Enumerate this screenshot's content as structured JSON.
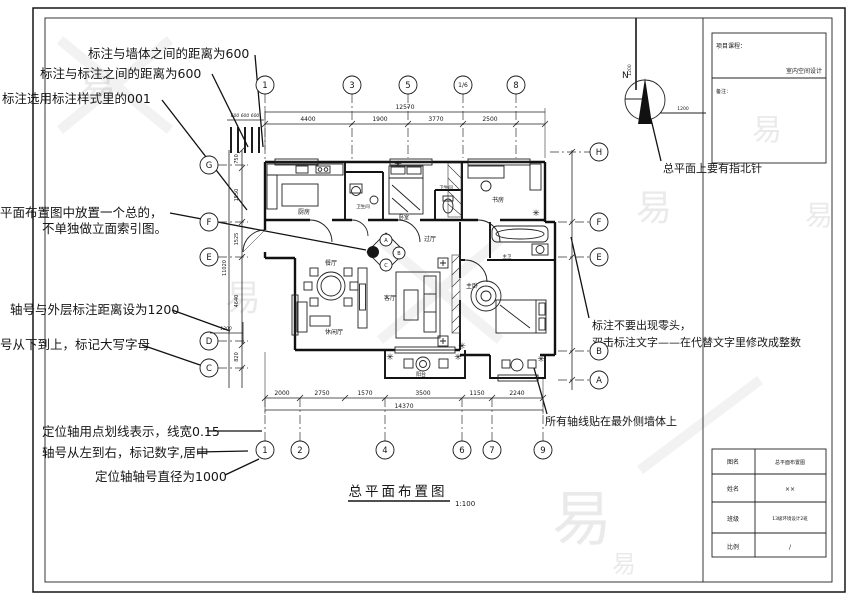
{
  "drawing_title": {
    "text": "总平面布置图",
    "scale": "1:100"
  },
  "north": {
    "label": "N",
    "dim_v": "1200",
    "dim_h": "1200",
    "note": "总平面上要有指北针"
  },
  "callouts": {
    "c1": "标注与墙体之间的距离为600",
    "c2": "标注与标注之间的距离为600",
    "c3": "标注选用标注样式里的001",
    "c4a": "平面布置图中放置一个总的，",
    "c4b": "不单独做立面索引图。",
    "c5": "轴号与外层标注距离设为1200",
    "c6": "号从下到上，标记大写字母",
    "c7": "定位轴用点划线表示，线宽0.15",
    "c8": "轴号从左到右，标记数字,居中",
    "c9": "定位轴轴号直径为1000",
    "c11a": "标注不要出现零头，",
    "c11b": "双击标注文字——在代替文字里修改成整数",
    "c12": "所有轴线贴在最外侧墙体上"
  },
  "axes": {
    "top": [
      "1",
      "3",
      "5",
      "1/6",
      "8"
    ],
    "bottom": [
      "1",
      "2",
      "4",
      "6",
      "7",
      "9"
    ],
    "left": [
      "G",
      "F",
      "E",
      "D",
      "C"
    ],
    "right": [
      "H",
      "F",
      "E",
      "B",
      "A"
    ]
  },
  "dims": {
    "top_total": "12570",
    "top_segments": [
      "4400",
      "1900",
      "3770",
      "2500"
    ],
    "wall_spacing": "600 600 600",
    "bottom_segments": [
      "2000",
      "2750",
      "1570",
      "3500",
      "1150",
      "2240"
    ],
    "bottom_total": "14370",
    "left_segments": [
      "750",
      "1550",
      "1525",
      "4640",
      "820"
    ],
    "left_total": "11020",
    "axis_offset": "1200"
  },
  "rooms": {
    "kitchen": "厨房",
    "bath": "卫生间",
    "bath2": "卫生间",
    "bedroom": "卧室",
    "study": "书房",
    "hall": "过厅",
    "dining": "餐厅",
    "living": "客厅",
    "leisure": "休闲厅",
    "master": "主卧",
    "master_bath": "主卫",
    "balcony": "阳台"
  },
  "index_symbol": {
    "a": "A",
    "b": "B",
    "c": "C"
  },
  "titleblock": {
    "course_label": "项目课程：",
    "course_value": "室内空间设计",
    "note_label": "备注：",
    "rows": [
      {
        "label": "图名",
        "value": "总平面布置图"
      },
      {
        "label": "姓名",
        "value": "××"
      },
      {
        "label": "班级",
        "value": "13级环境设计2班"
      },
      {
        "label": "比例",
        "value": "/"
      }
    ]
  },
  "watermark": {
    "glyph": "易"
  }
}
